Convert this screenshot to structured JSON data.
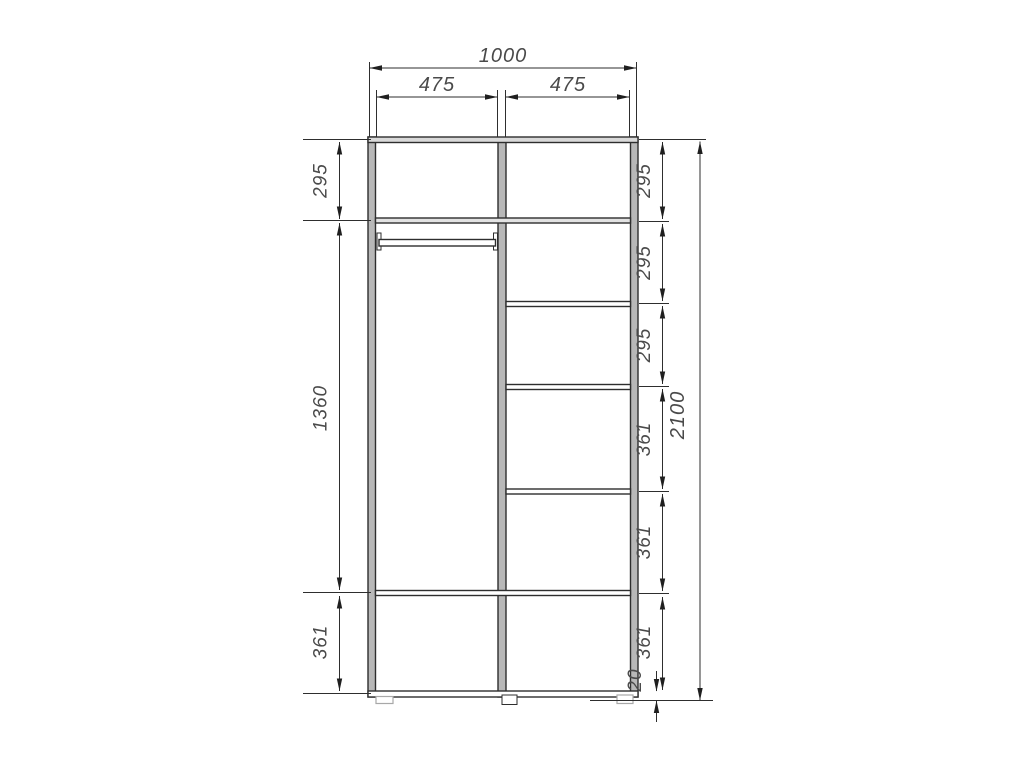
{
  "drawing": {
    "units": "mm",
    "top_dimensions": {
      "overall_width": "1000",
      "left_section_width": "475",
      "right_section_width": "475"
    },
    "left_chain": {
      "labels": [
        "295",
        "1360",
        "361"
      ]
    },
    "right_chain": {
      "labels": [
        "295",
        "295",
        "295",
        "361",
        "361",
        "361"
      ],
      "plinth_gap": "20"
    },
    "overall_height": "2100",
    "colors": {
      "panel_gray": "#b8b8b8",
      "shelf_tint": "#e2e2e2",
      "line_dark": "#2e2e2e",
      "text_gray": "#4a4a4a",
      "background": "#ffffff"
    }
  }
}
